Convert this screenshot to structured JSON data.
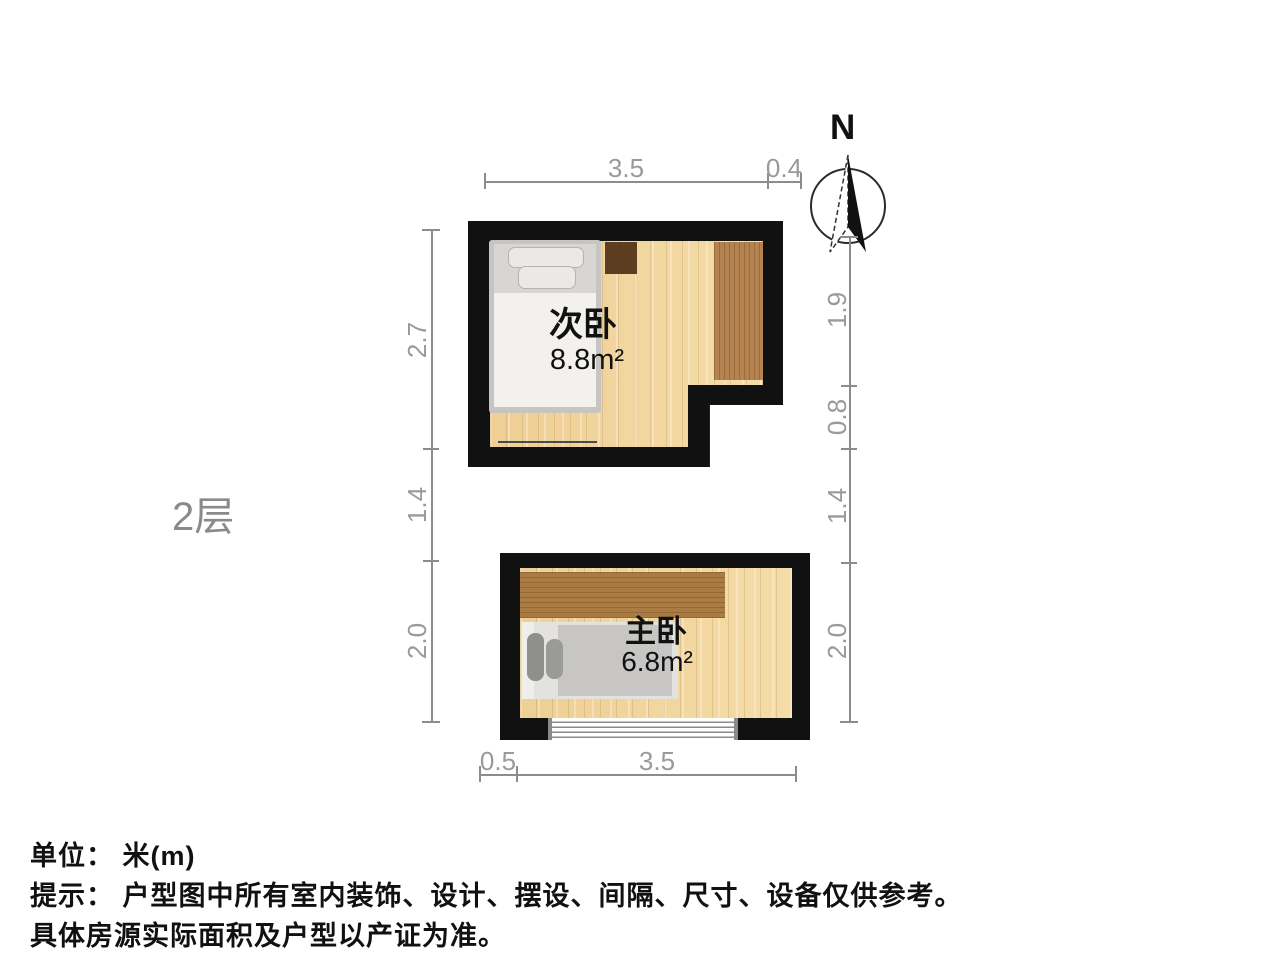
{
  "floor_label": "2层",
  "compass": {
    "label": "N"
  },
  "rooms": [
    {
      "name": "次卧",
      "area": "8.8m²"
    },
    {
      "name": "主卧",
      "area": "6.8m²"
    }
  ],
  "dimensions": {
    "top": [
      "3.5",
      "0.4"
    ],
    "bottom": [
      "0.5",
      "3.5"
    ],
    "left": [
      "2.7",
      "1.4",
      "2.0"
    ],
    "right": [
      "1.9",
      "0.8",
      "1.4",
      "2.0"
    ]
  },
  "footer": {
    "unit": "单位： 米(m)",
    "tip": "提示： 户型图中所有室内装饰、设计、摆设、间隔、尺寸、设备仅供参考。",
    "tip2": "具体房源实际面积及户型以产证为准。"
  },
  "colors": {
    "wall": "#111111",
    "floor": "#f0d49c",
    "wardrobe": "#b5834f",
    "cabinet": "#5d3d20",
    "dimension_gray": "#9a9a9a",
    "text": "#111111"
  }
}
